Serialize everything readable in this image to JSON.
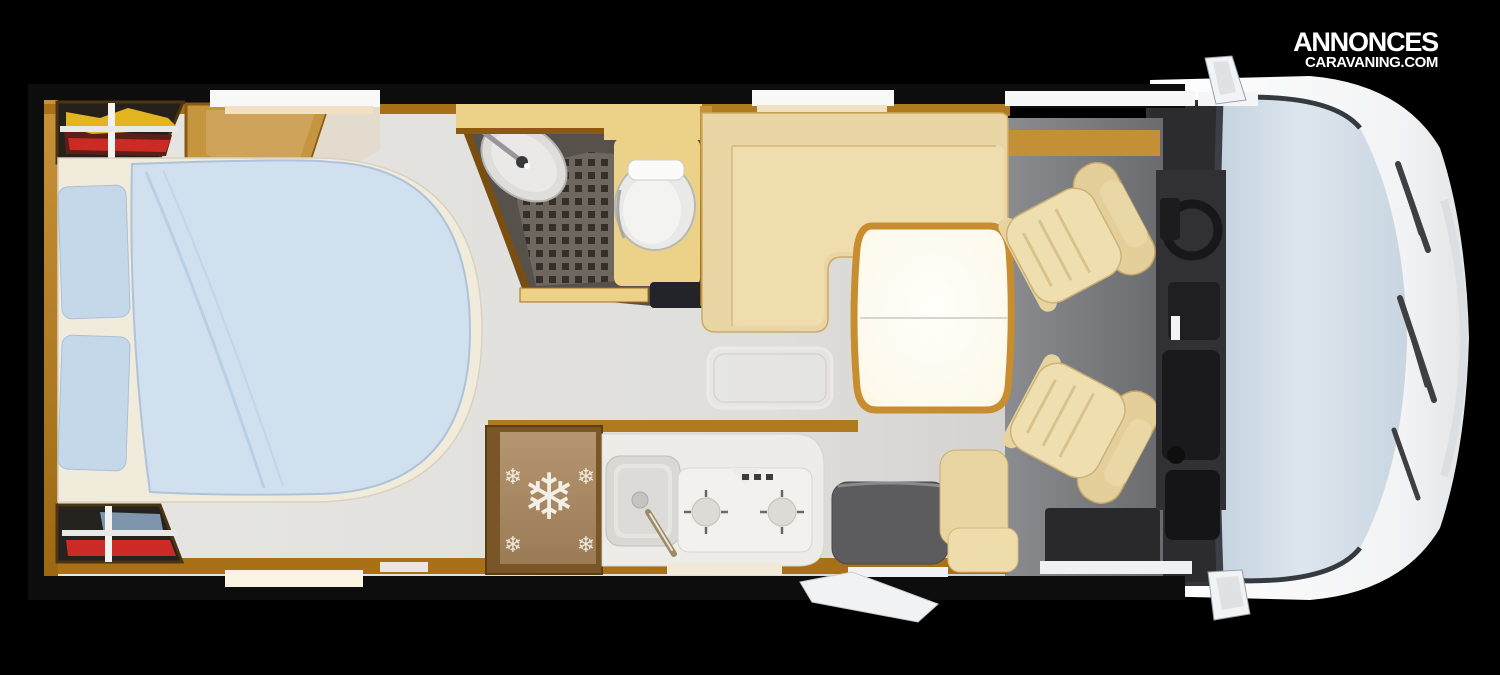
{
  "brand": {
    "line1": "ANNONCES",
    "line2": "CARAVANING.COM"
  },
  "icons": {
    "snowflake": "❄",
    "storage_cross_marker": "+"
  },
  "floorplan": {
    "type": "motorhome-top-view",
    "zones": [
      "rear-storage-top",
      "rear-storage-bottom",
      "island-bed",
      "wardrobe",
      "bathroom",
      "shower",
      "washbasin",
      "toilet",
      "kitchen",
      "fridge",
      "kitchen-sink",
      "cooktop",
      "lounge-sofa",
      "dinette-table",
      "floor-hatch",
      "entry-step-well",
      "side-seat",
      "entry-step-outside",
      "driver-seat",
      "passenger-seat",
      "dashboard",
      "steering-wheel",
      "windshield",
      "cab-body",
      "side-mirror-top",
      "side-mirror-bottom"
    ]
  },
  "palette": {
    "background": "#000000",
    "wall_black": "#0d0d0d",
    "wood_trim": "#b07a1e",
    "wood_light": "#cf9a3a",
    "floor_light": "#e1e0dd",
    "floor_cab": "#7e7f82",
    "bed_duvet": "#d0e0ef",
    "bed_pillow": "#c5d8ea",
    "mattress": "#f1ebdc",
    "sofa_beige": "#e9d6a4",
    "cushion_beige": "#efddad",
    "table_rim_gold": "#c88d2e",
    "table_top": "#fdfcf7",
    "bath_beige": "#ecd189",
    "bath_dark": "#57514b",
    "shower_tile": "#362f28",
    "toilet_white": "#e9e9e7",
    "fridge_wood": "#ab8b64",
    "counter_white": "#edece8",
    "step_well_gray": "#5c5c5e",
    "dashboard_dark": "#343438",
    "seat_beige": "#ecd9a8",
    "windshield_blue": "#cfdbe6",
    "body_white": "#f4f5f6",
    "item_yellow": "#e0b520",
    "item_red": "#cc2a25",
    "item_blue": "#7d96ad",
    "logo_white": "#ffffff"
  }
}
